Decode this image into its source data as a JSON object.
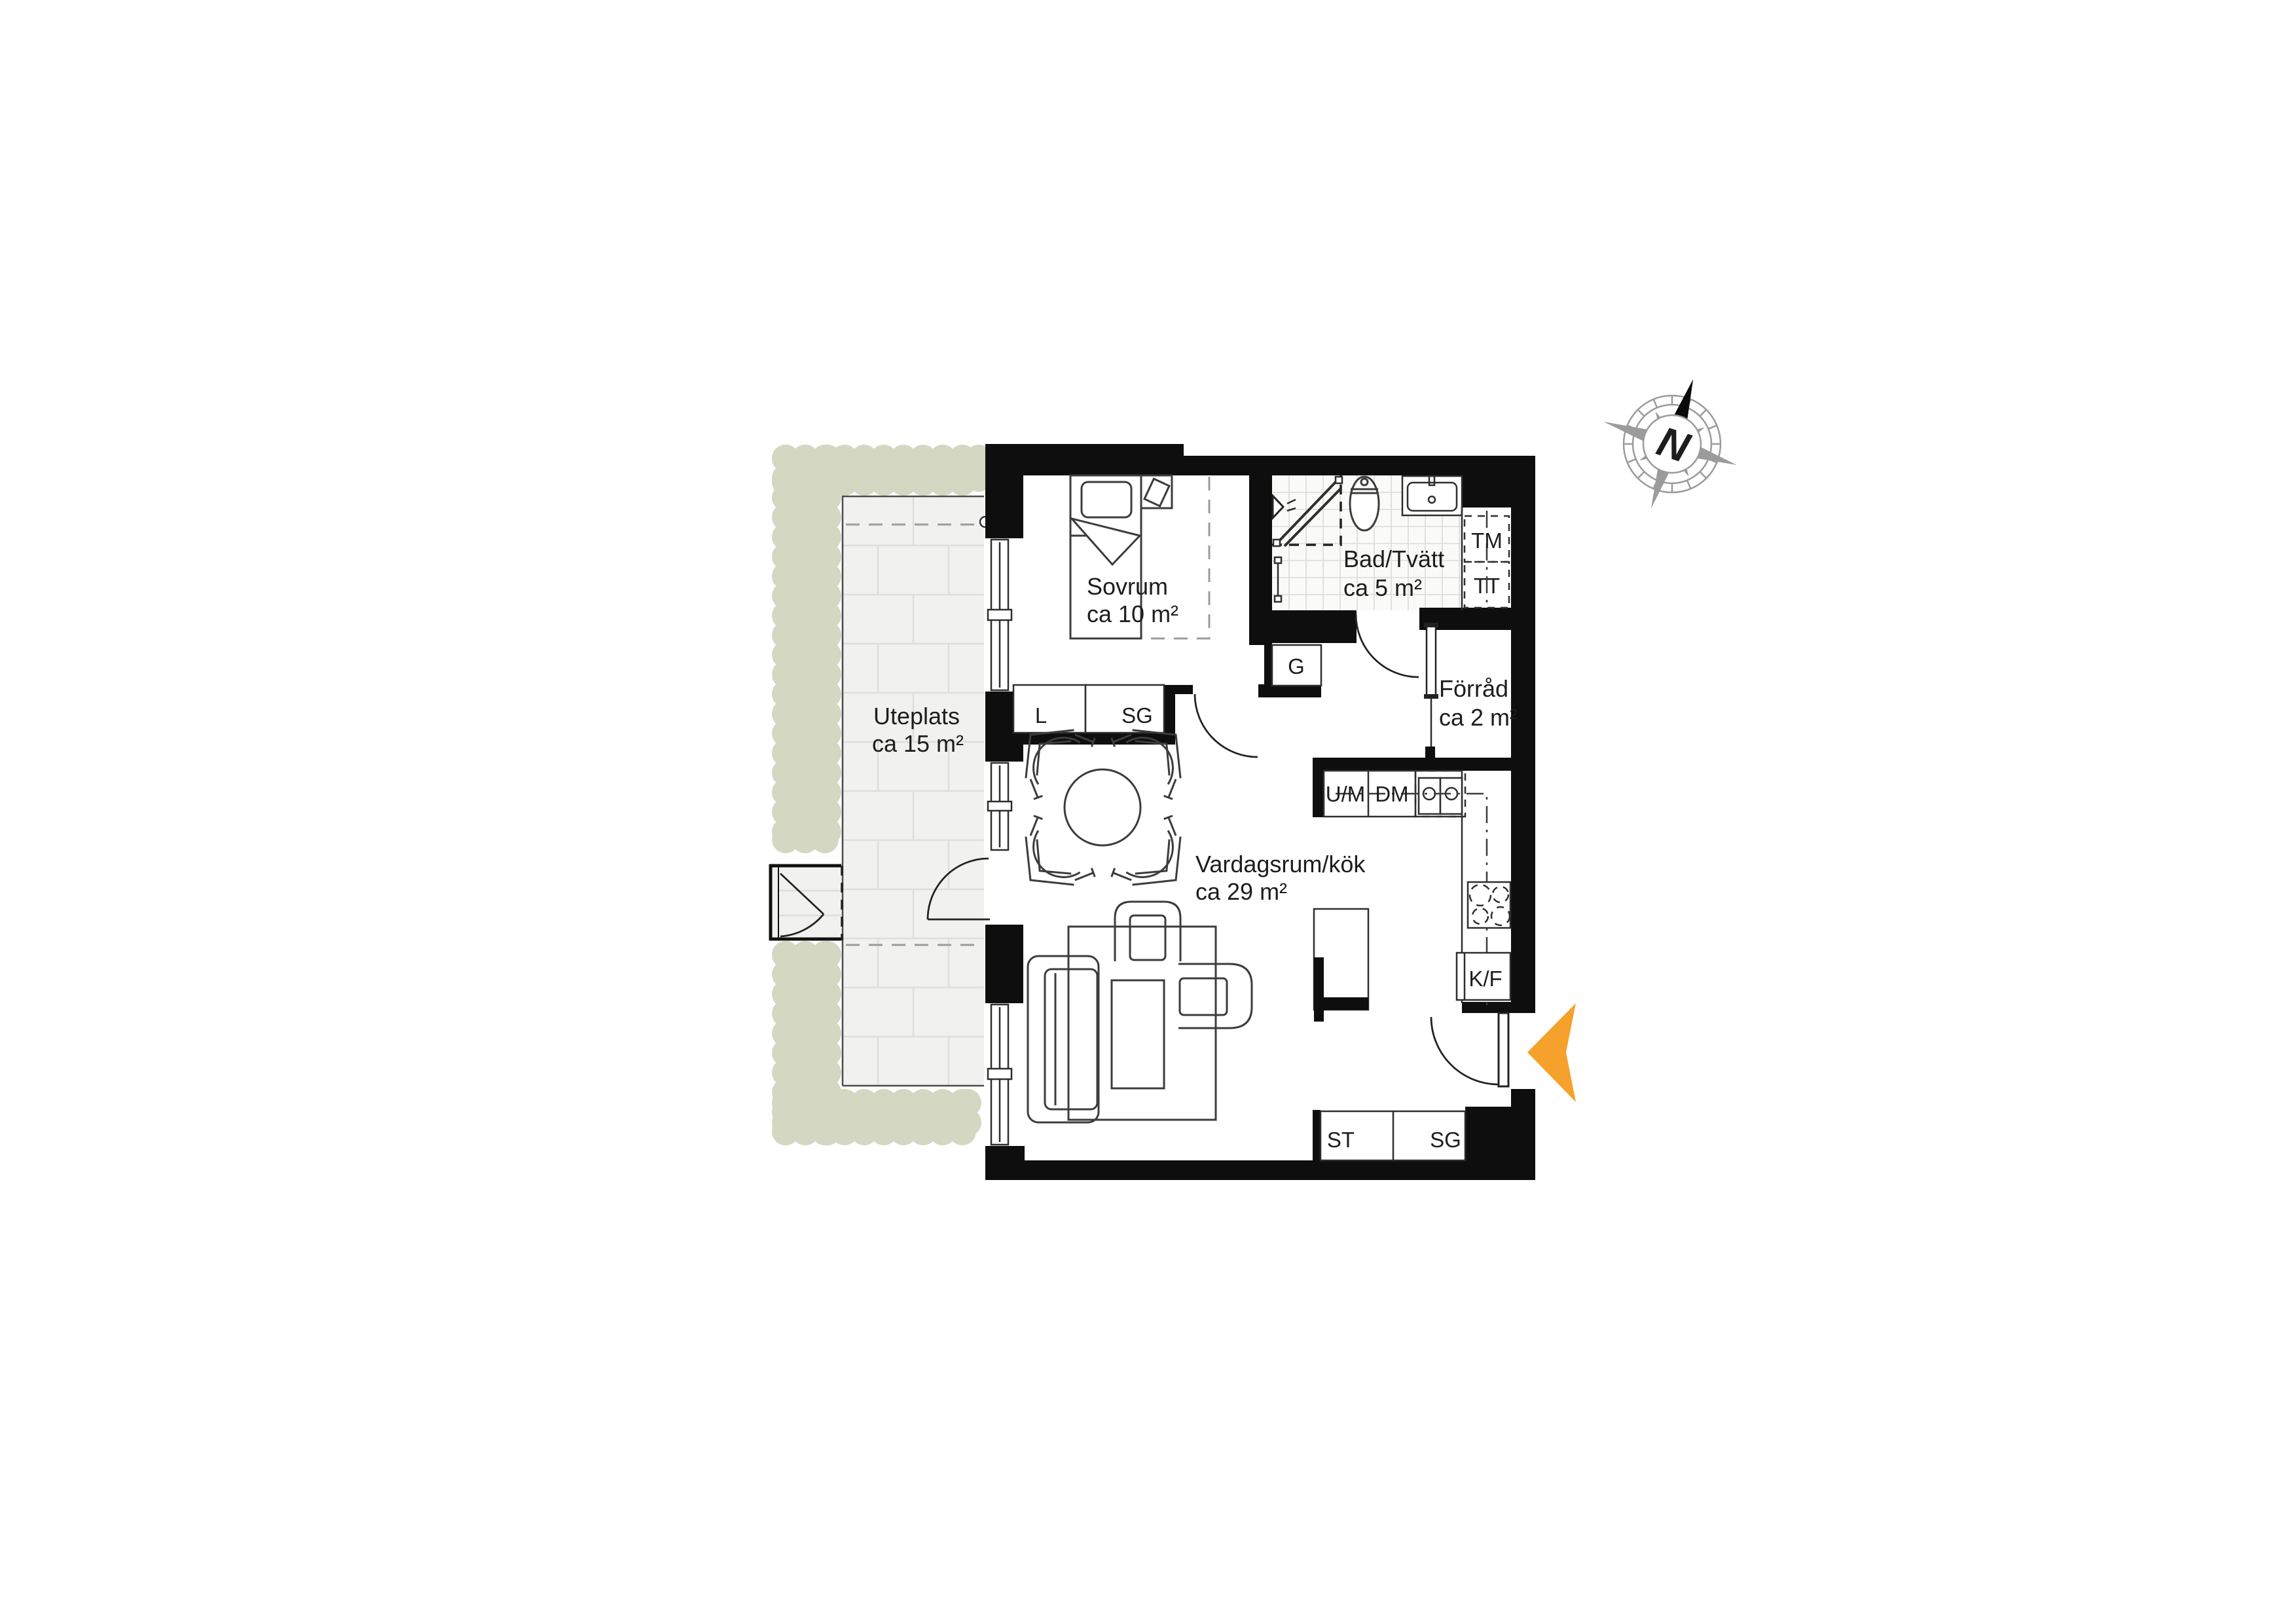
{
  "plan": {
    "rooms": [
      {
        "name": "Sovrum",
        "area": "ca 10 m²"
      },
      {
        "name": "Bad/Tvätt",
        "area": "ca 5 m²"
      },
      {
        "name": "Förråd",
        "area": "ca 2 m²"
      },
      {
        "name": "Vardagsrum/kök",
        "area": "ca 29 m²"
      },
      {
        "name": "Uteplats",
        "area": "ca 15 m²"
      }
    ],
    "fixtures": {
      "tm": "TM",
      "tt": "TT",
      "g": "G",
      "l": "L",
      "sg_bedroom": "SG",
      "um": "U/M",
      "dm": "DM",
      "kf": "K/F",
      "st": "ST",
      "sg_hall": "SG"
    },
    "compass": {
      "north": "N"
    },
    "colors": {
      "wall": "#0e0e0e",
      "hedge": "#d4d7c1",
      "patio_fill": "#f1f1ef",
      "patio_line": "#dededc",
      "tile_fill": "#fafaf8",
      "tile_line": "#dbdbd9",
      "entry_arrow": "#f5a12b",
      "compass_gray": "#9b9b9b",
      "ink": "#1d1d1d"
    }
  }
}
